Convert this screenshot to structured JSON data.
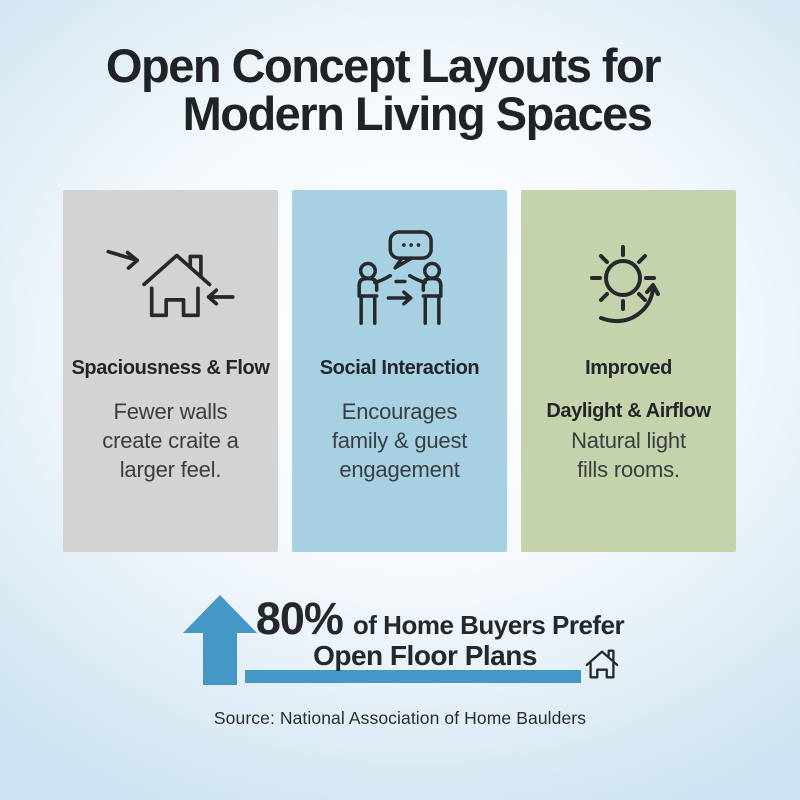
{
  "page": {
    "background_center_color": "#ffffff",
    "background_edge_color": "#cde3f1"
  },
  "title": {
    "line1": "Open Concept Layouts for",
    "line2": "Modern Living Spaces"
  },
  "cards": [
    {
      "icon": "house-with-arrows-icon",
      "title": "Spaciousness & Flow",
      "body_lines": [
        "Fewer walls",
        "create craite a",
        "larger feel."
      ],
      "bg_color": "#d2d3d2"
    },
    {
      "icon": "people-conversation-icon",
      "title": "Social Interaction",
      "body_lines": [
        "Encourages",
        "family & guest",
        "engagement"
      ],
      "bg_color": "#a7d1e2"
    },
    {
      "icon": "sun-rotation-icon",
      "title": "Improved",
      "subtitle": "Daylight & Airflow",
      "body_lines": [
        "Natural light",
        "fills rooms."
      ],
      "bg_color": "#c5d3ac"
    }
  ],
  "stat": {
    "value": "80%",
    "label": "of Home Buyers Prefer",
    "label_line2": "Open Floor Plans",
    "accent_color": "#4598c6"
  },
  "source": "Source: National Association of Home Baulders",
  "icon_stroke_color": "#26292c"
}
